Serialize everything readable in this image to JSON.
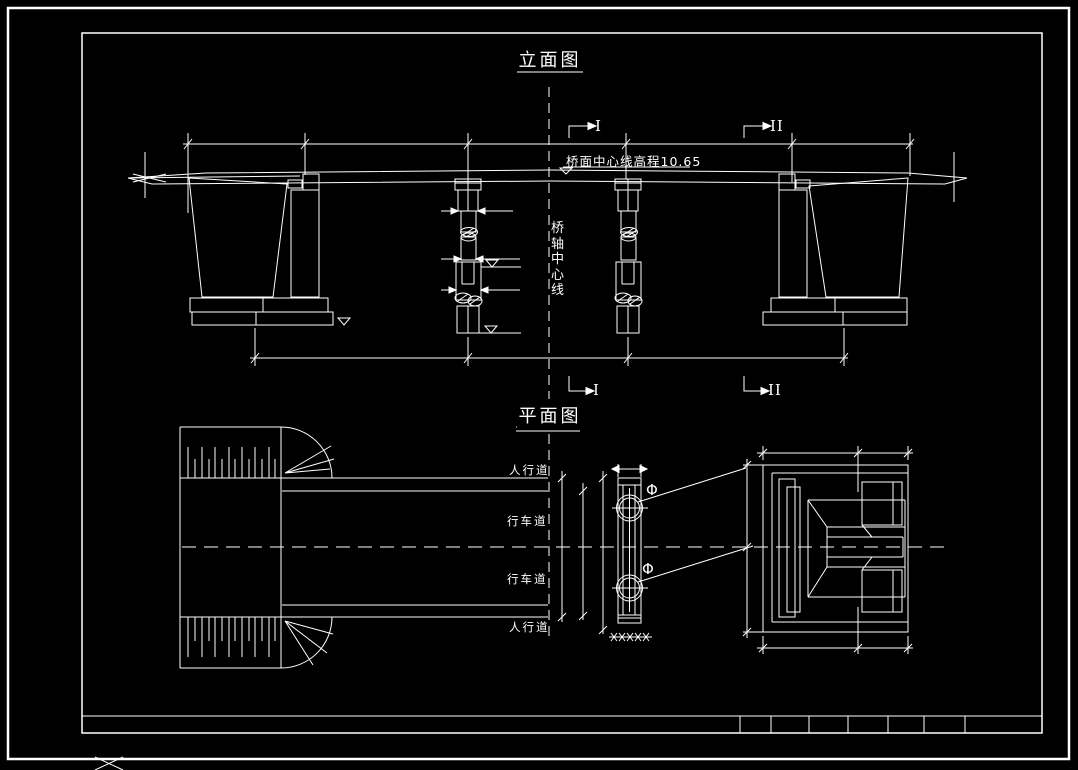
{
  "colors": {
    "background": "#000000",
    "line": "#ffffff"
  },
  "elevation": {
    "title": "立面图",
    "deck_note": "桥面中心线高程10.65",
    "axis_label": "桥轴中心线",
    "sections": {
      "s1": "I",
      "s2": "II"
    }
  },
  "plan": {
    "title": "平面图",
    "labels": {
      "sidewalk_top": "人行道",
      "lane_top": "行车道",
      "lane_bottom": "行车道",
      "sidewalk_bottom": "人行道"
    },
    "phi": "Φ"
  }
}
